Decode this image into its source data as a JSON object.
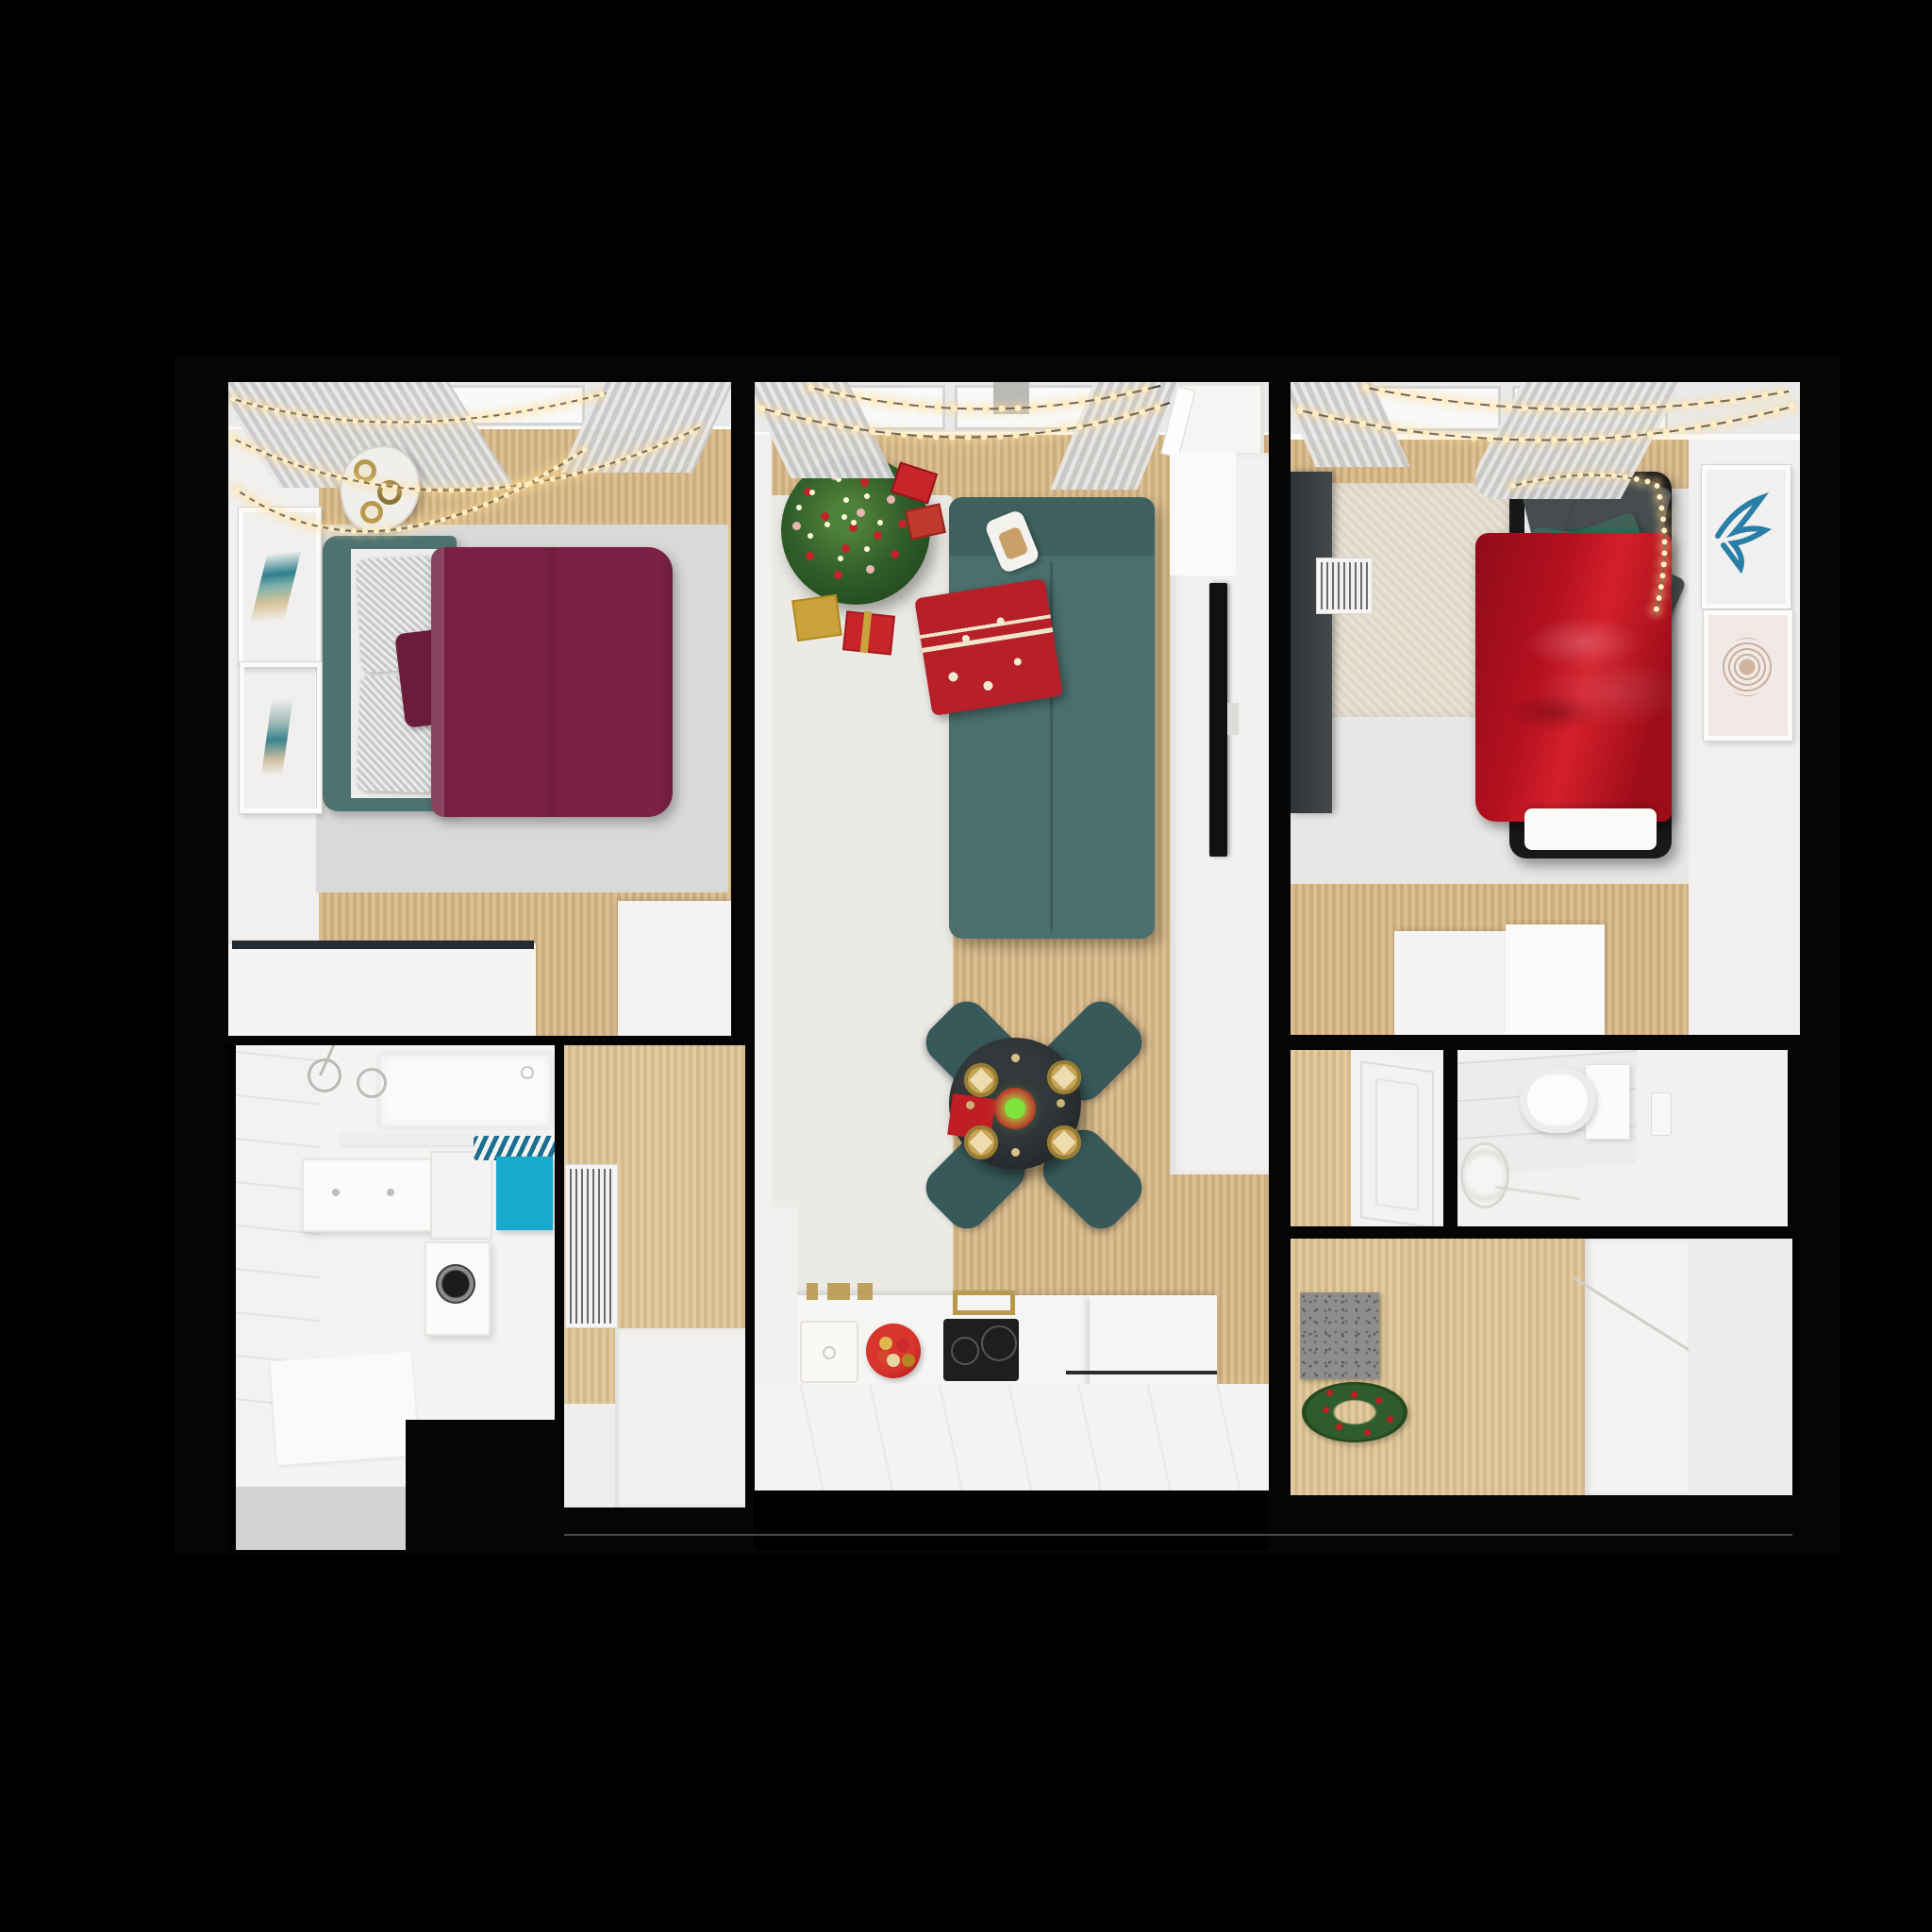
{
  "meta": {
    "title": "Christmas-decorated apartment 3D floor plan, top-down render",
    "view": "top-down isometric render",
    "background": "black"
  },
  "palette": {
    "wall": "#050505",
    "wood_a": "#dcc094",
    "wood_b": "#ccae7e",
    "wood_light_a": "#e3cb9f",
    "wood_light_b": "#d4b98a",
    "white_wall": "#f1f0ee",
    "white_floor": "#f4f3f1",
    "off_white": "#ebeae8",
    "sky": "#f8f9f9",
    "pane_frame": "#d3d4d4",
    "curtain_a": "#e8e8e8",
    "curtain_b": "#c9c9c9",
    "gray_rug": "#d9d9d7",
    "beige_rug": "#e5dfd1",
    "pale_rug": "#eceae5",
    "gray_floor": "#e8e7e5",
    "teal_head": "#4d7270",
    "teal_sofa": "#4a6f6d",
    "teal_dark": "#3e6160",
    "teal_chair": "#38595a",
    "burgundy": "#7c2145",
    "burgundy_dark": "#6c1c3b",
    "red_silk": "#b3101f",
    "red_throw": "#b72029",
    "ornament_red": "#c3242a",
    "ornament_pink": "#e7b6b1",
    "tree_green": "#31602b",
    "tree_green_dark": "#234a1f",
    "gold": "#b9994e",
    "plate_gold": "#c7a456",
    "napkin_beige": "#ecdcae",
    "bulb": "#ffeec4",
    "bulb_halo": "#ffd98f",
    "wire": "#3b3b33",
    "slate_pillow": "#474d4e",
    "black_frame": "#17181a",
    "tv_black": "#101112",
    "hob_black": "#1d1e1f",
    "glass_dark": "#262b31",
    "cyan_towel": "#18a9cd",
    "mat_gray": "#8e8d8b",
    "wreath_green": "#2e5b2b",
    "berry_red": "#c01d24",
    "glow_green": "#7fe23b",
    "mattress": "#ededec",
    "duvet_white": "#fafaf9"
  },
  "rooms": [
    {
      "name": "primary bedroom",
      "items": [
        "skylight window with sheer curtains",
        "string-light garlands",
        "two abstract wall art frames",
        "organic bedside table with three gold candles",
        "teal upholstered double bed",
        "two gray checkered pillows",
        "burgundy accent pillow",
        "burgundy duvet",
        "gray area rug",
        "white desk with dark glass shelf"
      ]
    },
    {
      "name": "living room",
      "items": [
        "decorated christmas tree with red and pink ornaments",
        "gift boxes in red and gold",
        "teal sofa",
        "red nordic-pattern throw blanket",
        "cocoa mug on sofa",
        "white media wall with mounted tv",
        "open white door",
        "round charcoal dining table",
        "four teal dining chairs",
        "four gold place settings with beige napkins",
        "red table napkin",
        "glowing green candle centerpiece",
        "sheer curtains",
        "string lights"
      ]
    },
    {
      "name": "kitchen",
      "items": [
        "white counter",
        "square sink",
        "gold faucet",
        "red bowl of christmas baubles",
        "black induction hob with two rings",
        "gold trivet",
        "white peninsula counter"
      ]
    },
    {
      "name": "secondary bedroom",
      "items": [
        "dark wardrobe",
        "white radiator grille",
        "beige rug",
        "black-frame single bed",
        "red silk blanket",
        "graphite and teal pillows",
        "white folded duvet",
        "fairy-light garland over bed",
        "blue botanical wall art",
        "blush abstract wall art",
        "white storage cabinets"
      ]
    },
    {
      "name": "bathroom",
      "items": [
        "bathtub",
        "shower fixtures",
        "white vanity cabinet",
        "washing machine with round door",
        "cyan towel on striped hanger"
      ]
    },
    {
      "name": "toilet room",
      "items": [
        "wall-hung toilet",
        "flush plate",
        "round washbasin",
        "gray wall tiles"
      ]
    },
    {
      "name": "hallway",
      "items": [
        "white radiator panel",
        "gray doormat",
        "christmas wreath with red berries",
        "white closet"
      ]
    }
  ],
  "lights": {
    "style": "warm glowing fairy lights strung across every window",
    "count_zones": 4
  }
}
